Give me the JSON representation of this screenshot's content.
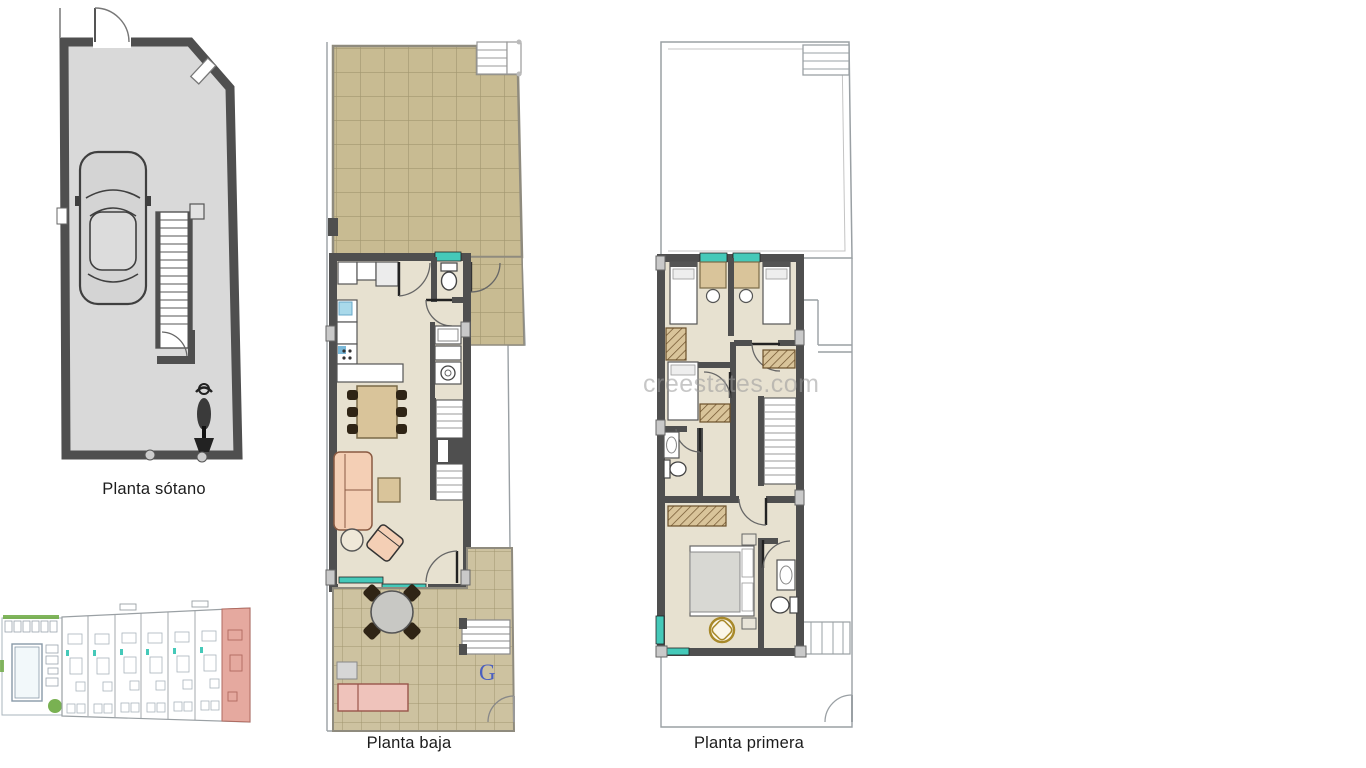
{
  "sheet": {
    "description": "Real-estate floor plan sheet with three stacked townhouse levels and a site plan thumbnail"
  },
  "plans": {
    "basement": {
      "label": "Planta sótano"
    },
    "ground": {
      "label": "Planta baja",
      "garage_mark": "G"
    },
    "first": {
      "label": "Planta primera"
    }
  },
  "watermark": {
    "text": "creestates.com"
  },
  "colors": {
    "wall": "#4f4f4f",
    "thinWall": "#8f8b7e",
    "thinLine": "#9aa0a4",
    "basementFloor": "#d9d9d9",
    "tile": "#c8bb92",
    "tileLine": "#a1966f",
    "patioTile": "#cdc2a0",
    "interiorFloor": "#e7e1d0",
    "furnitureTan": "#d9c49a",
    "furnitureDark": "#2f2415",
    "sofaPeach": "#f4cfb5",
    "loungerPink": "#efc3bb",
    "teal": "#45c9b9",
    "sinkBlue": "#a9d9ea",
    "bedGray": "#d8d8d3",
    "chairGold": "#a8892a",
    "unitPink": "#e5a99f",
    "unitPinkDark": "#b06a60",
    "siteGreen": "#6aa83f",
    "gMark": "#4a5fc0",
    "watermarkGray": "#9a9a9a",
    "labelText": "#1c1c1c"
  }
}
